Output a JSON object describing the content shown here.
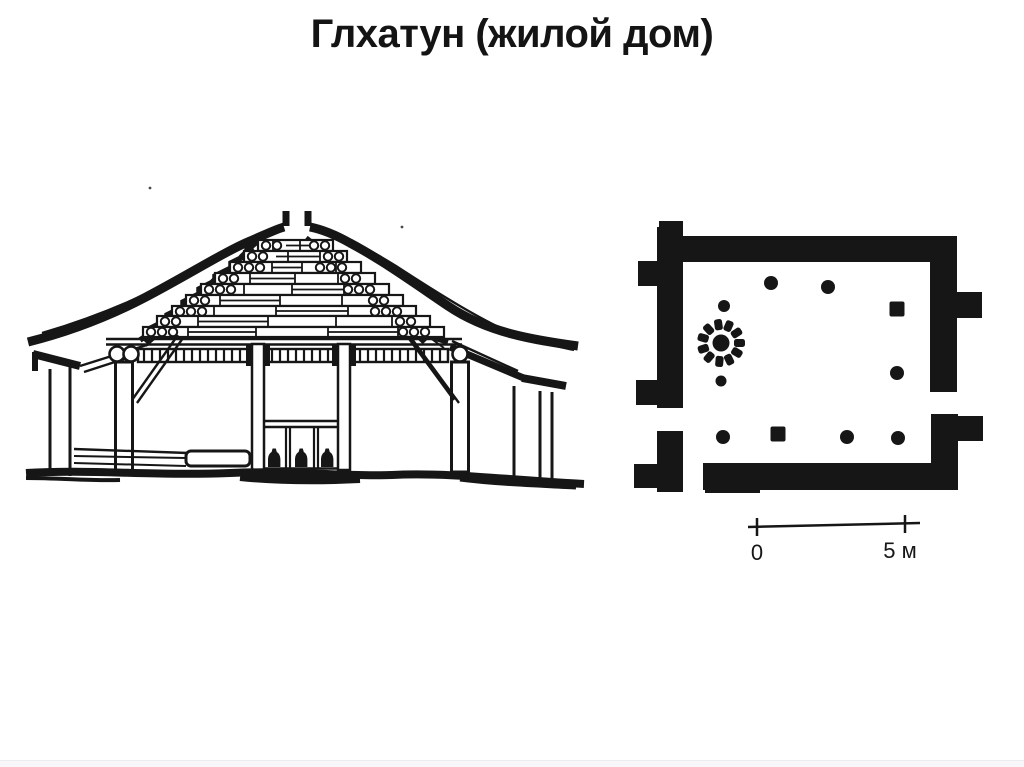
{
  "title": {
    "text": "Глхатун (жилой дом)"
  },
  "colors": {
    "ink": "#161616",
    "background": "#ffffff"
  },
  "plan": {
    "scale_bar": {
      "zero_label": "0",
      "end_label": "5 м"
    }
  }
}
